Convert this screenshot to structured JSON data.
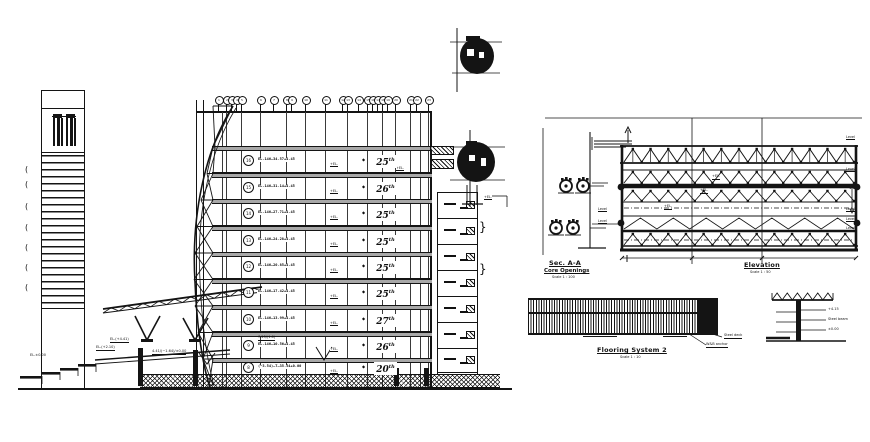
{
  "drawing": {
    "ink": "#141414",
    "gray": "#a8a8a8",
    "grid_bubbles": [
      "1",
      "2",
      "3",
      "4",
      "5",
      "6",
      "7",
      "8",
      "9",
      "10",
      "11",
      "12",
      "13",
      "14",
      "15",
      "16",
      "17",
      "18",
      "19",
      "20",
      "21",
      "22",
      "23"
    ],
    "floors": [
      {
        "num": "16",
        "elev": "EL.146—34.57+4.45",
        "tag": "+EL.",
        "label": "25",
        "sup": "th"
      },
      {
        "num": "15",
        "elev": "EL.146—31.14+4.45",
        "tag": "+EL.",
        "label": "26",
        "sup": "th"
      },
      {
        "num": "14",
        "elev": "EL.146—27.71+4.45",
        "tag": "+EL.",
        "label": "25",
        "sup": "th"
      },
      {
        "num": "13",
        "elev": "EL.146—24.28+4.45",
        "tag": "+EL.",
        "label": "25",
        "sup": "th"
      },
      {
        "num": "12",
        "elev": "EL.146—20.85+4.45",
        "tag": "+EL.",
        "label": "25",
        "sup": "th"
      },
      {
        "num": "11",
        "elev": "EL.146—17.42+4.45",
        "tag": "+EL.",
        "label": "25",
        "sup": "th"
      },
      {
        "num": "10",
        "elev": "EL.146—13.99+4.45",
        "tag": "+EL.",
        "label": "27",
        "sup": "th"
      },
      {
        "num": "9",
        "elev": "EL.146—10.56+4.45",
        "tag": "+EL.",
        "label": "26",
        "sup": "th"
      },
      {
        "num": "8",
        "elev": "(−3.54)—T—35.54+0.00",
        "tag": "+EL.",
        "label": "20",
        "sup": "th"
      }
    ],
    "attic_tag": "+EL.",
    "annex_tag": "+EL.",
    "ramp_labels": [
      {
        "text": "EL.(+4.41)",
        "x": 110,
        "y": 338,
        "u": true
      },
      {
        "text": "EL.(+2.10)",
        "x": 96,
        "y": 346,
        "u": true
      },
      {
        "text": "EL.±0.00",
        "x": 30,
        "y": 354,
        "u": false
      },
      {
        "text": "4.41/(−1.64)/±0.00",
        "x": 152,
        "y": 350,
        "u": true
      },
      {
        "text": "7.25/(1.0)",
        "x": 258,
        "y": 336,
        "u": true
      }
    ],
    "sec_aa": {
      "title": "Sec. A-A",
      "subtitle": "Core Openings",
      "scale": "Scale 1 : 100"
    },
    "elevation": {
      "title": "Elevation",
      "scale": "Scale 1 : 50"
    },
    "level_tags_right": [
      {
        "text": "Level",
        "y": 136
      },
      {
        "text": "Level",
        "y": 168
      },
      {
        "text": "Level",
        "y": 208
      },
      {
        "text": "Level",
        "y": 218
      },
      {
        "text": "Level",
        "y": 227
      }
    ],
    "level_tags_left": [
      {
        "text": "Level",
        "y": 208
      },
      {
        "text": "Level",
        "y": 220
      }
    ],
    "truss_annotations": [
      {
        "text": "+EL.",
        "x": 712,
        "y": 175
      },
      {
        "text": "+EL.",
        "x": 700,
        "y": 189
      },
      {
        "text": "+EL.",
        "x": 664,
        "y": 205
      }
    ],
    "flooring": {
      "title": "Flooring System 2",
      "scale": "Scale 1 : 10",
      "callouts": [
        {
          "text": "Steel deck",
          "x": 724,
          "y": 334
        },
        {
          "text": "W&B anchor",
          "x": 706,
          "y": 343
        }
      ]
    },
    "tree_labels": [
      {
        "text": "+4.15",
        "x": 828,
        "y": 308
      },
      {
        "text": "Steel beam",
        "x": 828,
        "y": 318
      },
      {
        "text": "±0.00",
        "x": 828,
        "y": 328
      }
    ]
  }
}
